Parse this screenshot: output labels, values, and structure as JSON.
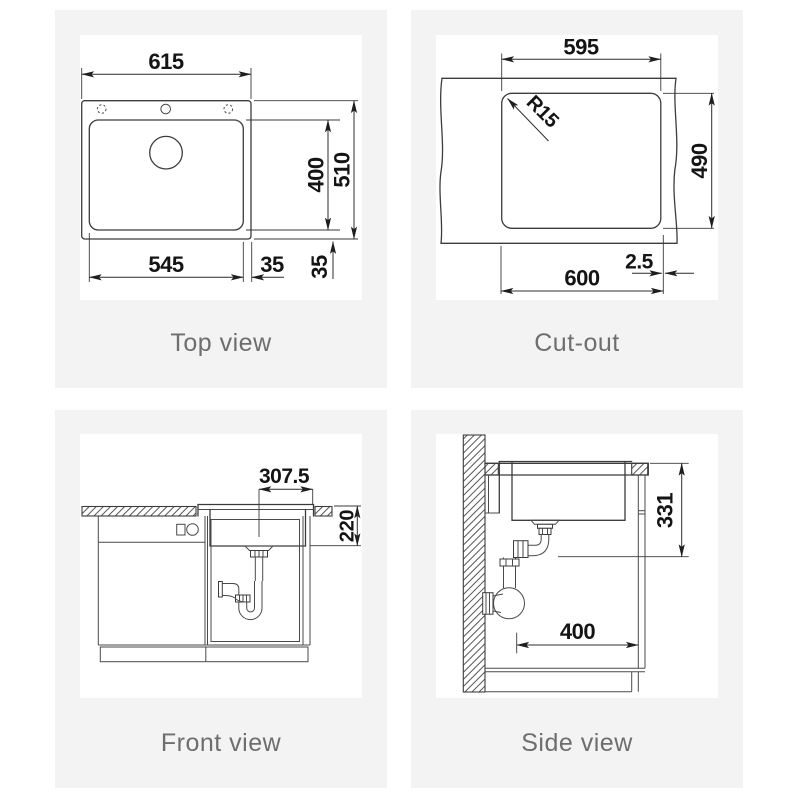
{
  "colors": {
    "page_background": "#ffffff",
    "panel_background": "#f3f3f4",
    "drawing_area": "#ffffff",
    "line": "#3c3c3c",
    "dimension_text": "#141414",
    "caption_text": "#6e6e6e"
  },
  "views": {
    "top_view": {
      "caption": "Top view",
      "dims": {
        "overall_width": "615",
        "bowl_length": "400",
        "overall_depth": "510",
        "bowl_width": "545",
        "edge_offset_horizontal": "35",
        "edge_offset_vertical": "35"
      }
    },
    "cut_out": {
      "caption": "Cut-out",
      "dims": {
        "top_width": "595",
        "corner_radius": "R15",
        "height": "490",
        "bottom_width": "600",
        "edge_offset": "2.5"
      }
    },
    "front_view": {
      "caption": "Front view",
      "dims": {
        "drain_center_offset": "307.5",
        "bowl_depth": "220"
      }
    },
    "side_view": {
      "caption": "Side view",
      "dims": {
        "depth_below_counter": "331",
        "cabinet_clearance": "400"
      }
    }
  }
}
